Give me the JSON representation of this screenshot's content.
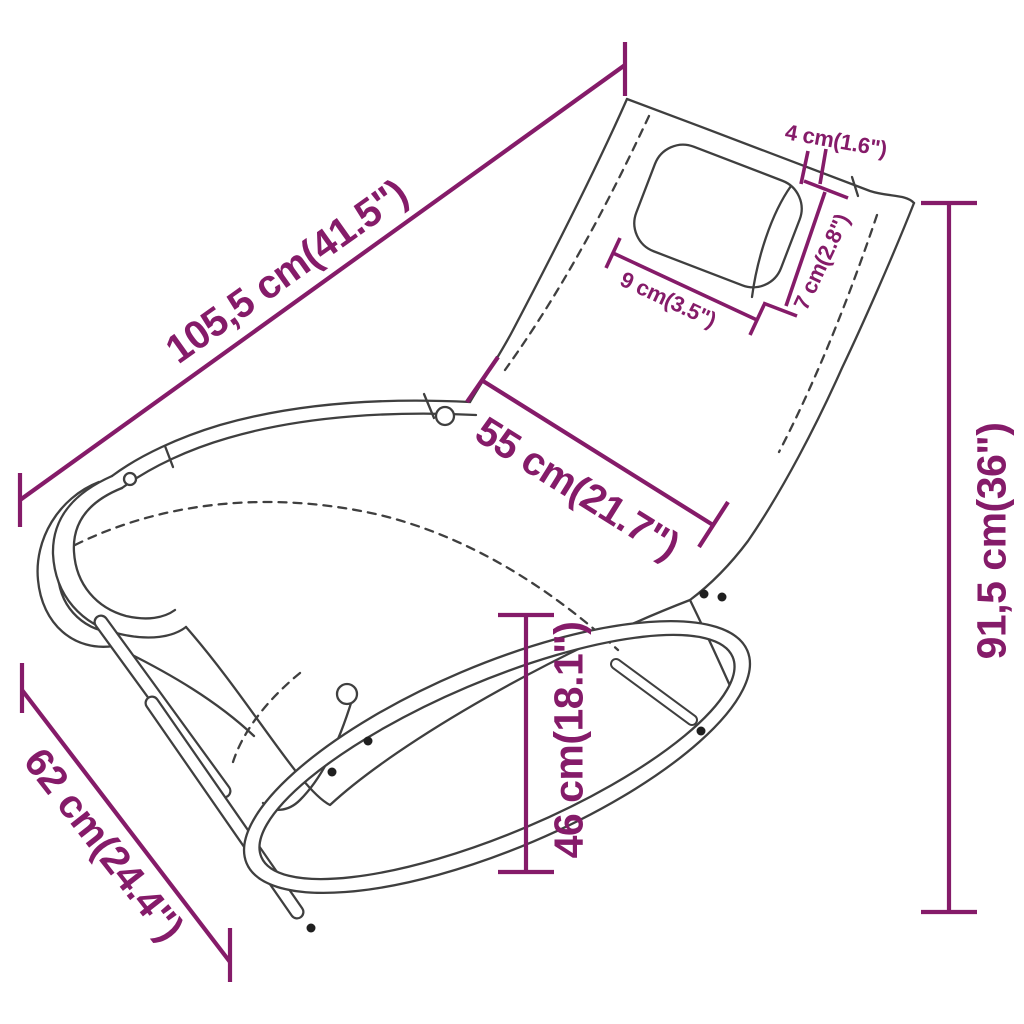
{
  "theme": {
    "accent_color": "#851b69",
    "line_color": "#3f3f3f",
    "background": "#ffffff"
  },
  "diagram": {
    "artwork": "rocking-sun-lounger-with-pillow-line-art",
    "dimensions": [
      {
        "id": "length",
        "label": "105,5 cm(41.5\")",
        "value_cm": "105,5",
        "value_inch": "41.5"
      },
      {
        "id": "seat-width",
        "label": "55 cm(21.7\")",
        "value_cm": "55",
        "value_inch": "21.7"
      },
      {
        "id": "base-width",
        "label": "62 cm(24.4\")",
        "value_cm": "62",
        "value_inch": "24.4"
      },
      {
        "id": "seat-height",
        "label": "46 cm(18.1\")",
        "value_cm": "46",
        "value_inch": "18.1"
      },
      {
        "id": "total-height",
        "label": "91,5 cm(36\")",
        "value_cm": "91,5",
        "value_inch": "36"
      },
      {
        "id": "pillow-thickness",
        "label": "4 cm(1.6\")",
        "value_cm": "4",
        "value_inch": "1.6"
      },
      {
        "id": "pillow-side",
        "label": "7 cm(2.8\")",
        "value_cm": "7",
        "value_inch": "2.8"
      },
      {
        "id": "pillow-width",
        "label": "9 cm(3.5\")",
        "value_cm": "9",
        "value_inch": "3.5"
      }
    ]
  }
}
